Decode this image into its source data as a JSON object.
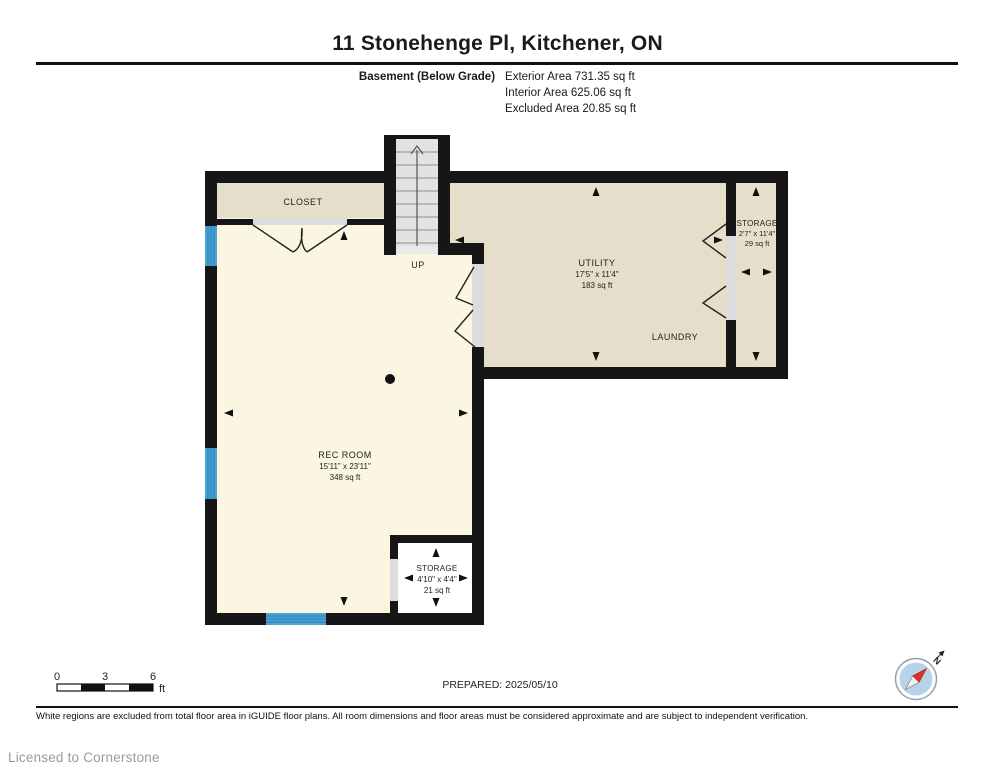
{
  "header": {
    "title": "11 Stonehenge Pl, Kitchener, ON",
    "floor_label": "Basement (Below Grade)",
    "exterior_area": "Exterior Area 731.35 sq ft",
    "interior_area": "Interior Area 625.06 sq ft",
    "excluded_area": "Excluded Area 20.85 sq ft"
  },
  "plan": {
    "rooms": {
      "closet": {
        "name": "CLOSET"
      },
      "utility": {
        "name": "UTILITY",
        "dims": "17'5\" x 11'4\"",
        "area": "183 sq ft"
      },
      "laundry": {
        "name": "LAUNDRY"
      },
      "storage_right": {
        "name": "STORAGE",
        "dims": "2'7\" x 11'4\"",
        "area": "29 sq ft"
      },
      "rec_room": {
        "name": "REC ROOM",
        "dims": "15'11\" x 23'11\"",
        "area": "348 sq ft"
      },
      "storage_small": {
        "name": "STORAGE",
        "dims": "4'10\" x 4'4\"",
        "area": "21 sq ft"
      }
    },
    "stairs_label": "UP"
  },
  "footer": {
    "scale": {
      "tick0": "0",
      "tick3": "3",
      "tick6": "6",
      "unit": "ft"
    },
    "prepared": "PREPARED: 2025/05/10",
    "compass_north": "N",
    "disclaimer": "White regions are excluded from total floor area in iGUIDE floor plans. All room dimensions and floor areas must be considered approximate and are subject to independent verification.",
    "licensed": "Licensed to Cornerstone"
  },
  "colors": {
    "wall": "#161616",
    "room_beige": "#e5decb",
    "room_yellow": "#fbf6e2",
    "excluded_white": "#ffffff",
    "door_opening_gray": "#dcdcdc",
    "stairs_gray": "#e2e2e2",
    "window_blue": "#4aa3d6",
    "window_stripe_blue": "#2b7cb3",
    "compass_blue": "#b7d3e9",
    "compass_needle_red": "#d93025"
  }
}
